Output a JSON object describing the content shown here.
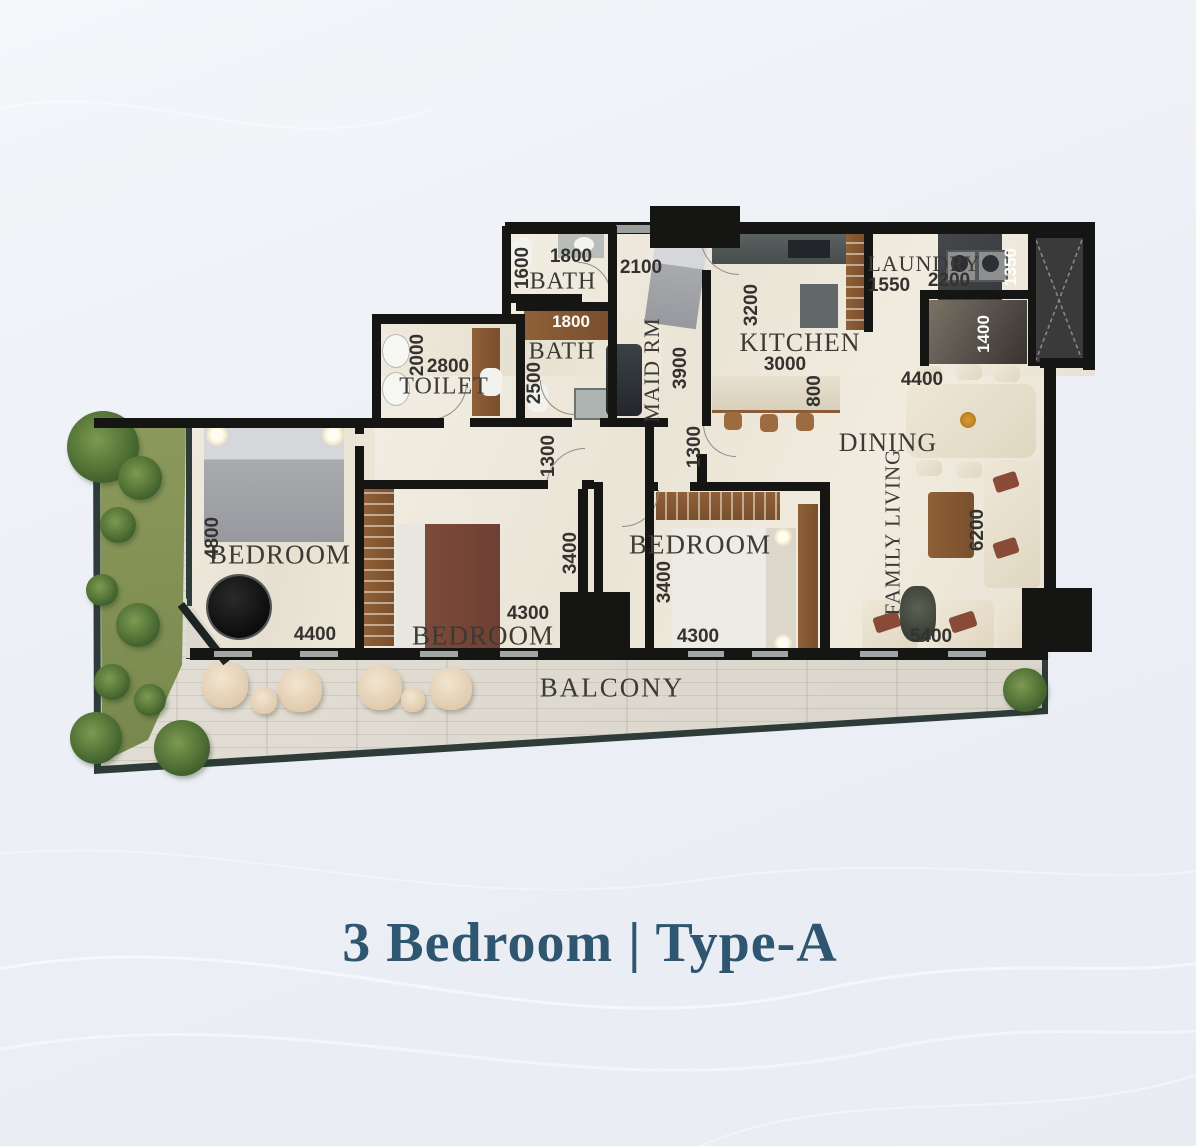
{
  "title": {
    "text": "3 Bedroom | Type-A",
    "color": "#2e5670"
  },
  "plan": {
    "rooms": {
      "bath1": {
        "label": "BATH",
        "width": "1800",
        "height": "1600"
      },
      "bath2": {
        "label": "BATH",
        "width": "1800",
        "height": "2500"
      },
      "toilet": {
        "label": "TOILET",
        "width": "2800",
        "height": "2000"
      },
      "maid": {
        "label": "MAID RM",
        "width": "2100",
        "height": "3900"
      },
      "kitchen": {
        "label": "KITCHEN",
        "width": "3000",
        "depth": "3200",
        "island": "800"
      },
      "laundry": {
        "label": "LAUNDRY",
        "width": "1550",
        "width2": "2200",
        "depth": "1350",
        "store_depth": "1400"
      },
      "dining": {
        "label": "DINING",
        "width": "4400"
      },
      "family_living": {
        "label": "FAMILY LIVING",
        "length": "6200",
        "width": "5400"
      },
      "bedroom1": {
        "label": "BEDROOM",
        "height": "4800",
        "width": "4400"
      },
      "bedroom2": {
        "label": "BEDROOM",
        "width": "4300"
      },
      "bedroom3": {
        "label": "BEDROOM",
        "height": "3400",
        "width": "4300"
      },
      "balcony": {
        "label": "BALCONY"
      }
    },
    "halls": {
      "foyer1": "1300",
      "foyer2": "1300",
      "corridor": "3400"
    }
  },
  "colors": {
    "title_accent": "#2e5670",
    "wall": "#151513",
    "floor_marble": "#eee8db",
    "balcony_deck": "#dedad1",
    "wood": "#8a5c38",
    "greenery": "#55763a",
    "background": "#edf0f5"
  }
}
